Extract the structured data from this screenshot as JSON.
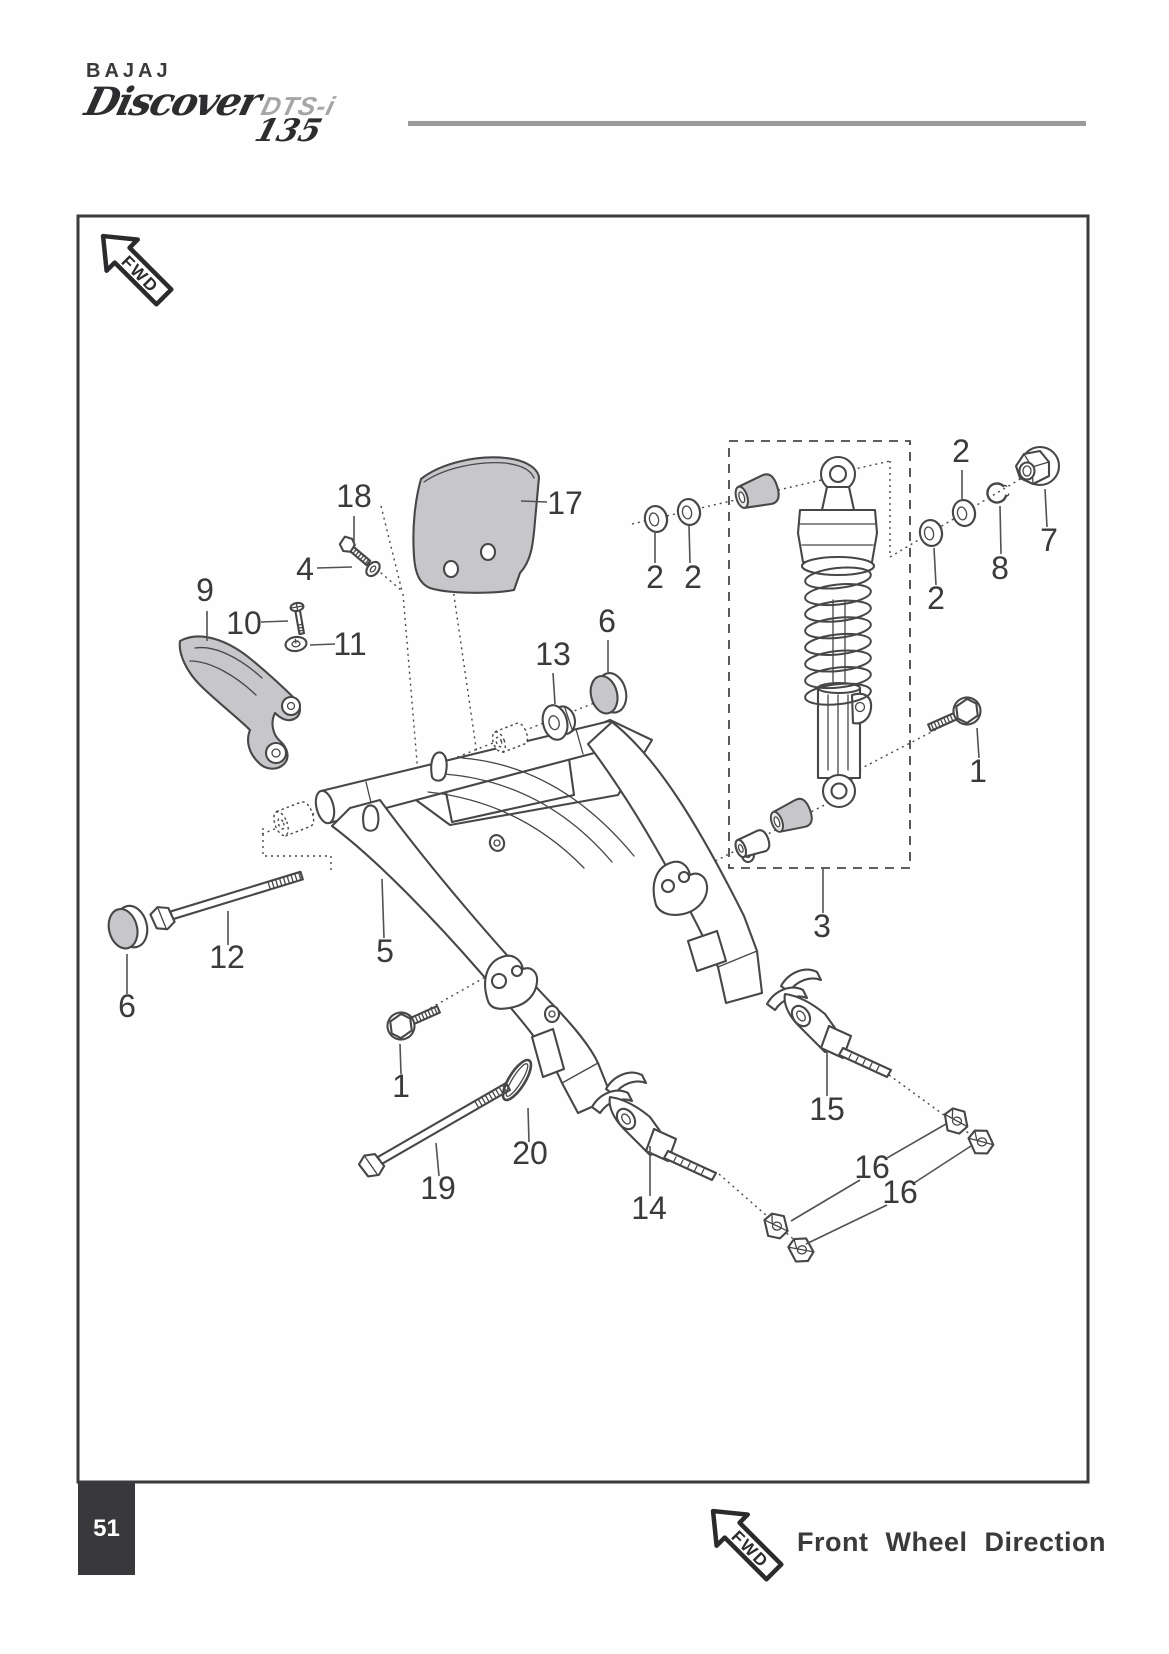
{
  "brand": {
    "name": "BAJAJ",
    "model": "Discover",
    "trim": "DTS-i",
    "displacement": "135"
  },
  "page": {
    "number": "51"
  },
  "footer": {
    "fwd": "FWD",
    "caption": "Front Wheel Direction"
  },
  "diagram": {
    "fwd": "FWD",
    "callouts": [
      {
        "label": "18",
        "x": 354,
        "y": 507,
        "leaders": [
          [
            354,
            516,
            354,
            546
          ]
        ]
      },
      {
        "label": "17",
        "x": 565,
        "y": 514,
        "leaders": [
          [
            521,
            501,
            547,
            502
          ]
        ]
      },
      {
        "label": "4",
        "x": 305,
        "y": 580,
        "leaders": [
          [
            317,
            568,
            352,
            567
          ]
        ]
      },
      {
        "label": "9",
        "x": 205,
        "y": 601,
        "leaders": [
          [
            207,
            611,
            207,
            641
          ]
        ]
      },
      {
        "label": "10",
        "x": 244,
        "y": 634,
        "leaders": [
          [
            261,
            622,
            288,
            621
          ]
        ]
      },
      {
        "label": "11",
        "x": 350,
        "y": 655,
        "leaders": [
          [
            335,
            644,
            310,
            645
          ]
        ]
      },
      {
        "label": "13",
        "x": 553,
        "y": 665,
        "leaders": [
          [
            553,
            673,
            555,
            704
          ]
        ]
      },
      {
        "label": "6",
        "x": 607,
        "y": 632,
        "leaders": [
          [
            608,
            640,
            608,
            672
          ]
        ]
      },
      {
        "label": "2",
        "x": 655,
        "y": 588,
        "leaders": [
          [
            655,
            563,
            655,
            533
          ]
        ]
      },
      {
        "label": "2",
        "x": 693,
        "y": 588,
        "leaders": [
          [
            690,
            563,
            689,
            526
          ]
        ]
      },
      {
        "label": "2",
        "x": 961,
        "y": 462,
        "leaders": [
          [
            962,
            470,
            962,
            499
          ]
        ]
      },
      {
        "label": "2",
        "x": 936,
        "y": 609,
        "leaders": [
          [
            936,
            585,
            934,
            548
          ]
        ]
      },
      {
        "label": "8",
        "x": 1000,
        "y": 579,
        "leaders": [
          [
            1001,
            554,
            1000,
            506
          ]
        ]
      },
      {
        "label": "7",
        "x": 1049,
        "y": 551,
        "leaders": [
          [
            1047,
            527,
            1045,
            489
          ]
        ]
      },
      {
        "label": "1",
        "x": 978,
        "y": 782,
        "leaders": [
          [
            979,
            758,
            977,
            728
          ]
        ]
      },
      {
        "label": "3",
        "x": 822,
        "y": 937,
        "leaders": [
          [
            823,
            913,
            823,
            869
          ]
        ]
      },
      {
        "label": "5",
        "x": 385,
        "y": 962,
        "leaders": [
          [
            384,
            938,
            382,
            879
          ]
        ]
      },
      {
        "label": "12",
        "x": 227,
        "y": 968,
        "leaders": [
          [
            228,
            945,
            228,
            911
          ]
        ]
      },
      {
        "label": "6",
        "x": 127,
        "y": 1017,
        "leaders": [
          [
            127,
            994,
            127,
            954
          ]
        ]
      },
      {
        "label": "1",
        "x": 401,
        "y": 1097,
        "leaders": [
          [
            401,
            1074,
            400,
            1044
          ]
        ]
      },
      {
        "label": "19",
        "x": 438,
        "y": 1199,
        "leaders": [
          [
            439,
            1176,
            436,
            1143
          ]
        ]
      },
      {
        "label": "20",
        "x": 530,
        "y": 1164,
        "leaders": [
          [
            529,
            1142,
            528,
            1108
          ]
        ]
      },
      {
        "label": "14",
        "x": 649,
        "y": 1219,
        "leaders": [
          [
            650,
            1196,
            650,
            1146
          ]
        ]
      },
      {
        "label": "15",
        "x": 827,
        "y": 1120,
        "leaders": [
          [
            827,
            1096,
            827,
            1050
          ]
        ]
      },
      {
        "label": "16",
        "x": 872,
        "y": 1178,
        "leaders": [
          [
            887,
            1158,
            946,
            1124
          ],
          [
            860,
            1180,
            791,
            1221
          ]
        ]
      },
      {
        "label": "16",
        "x": 900,
        "y": 1203,
        "leaders": [
          [
            914,
            1183,
            971,
            1146
          ],
          [
            887,
            1205,
            806,
            1244
          ]
        ]
      }
    ]
  },
  "colors": {
    "ink": "#3a3a3c",
    "line": "#47474a",
    "shade": "#c7c7c9",
    "rule": "#9b9b9e"
  }
}
